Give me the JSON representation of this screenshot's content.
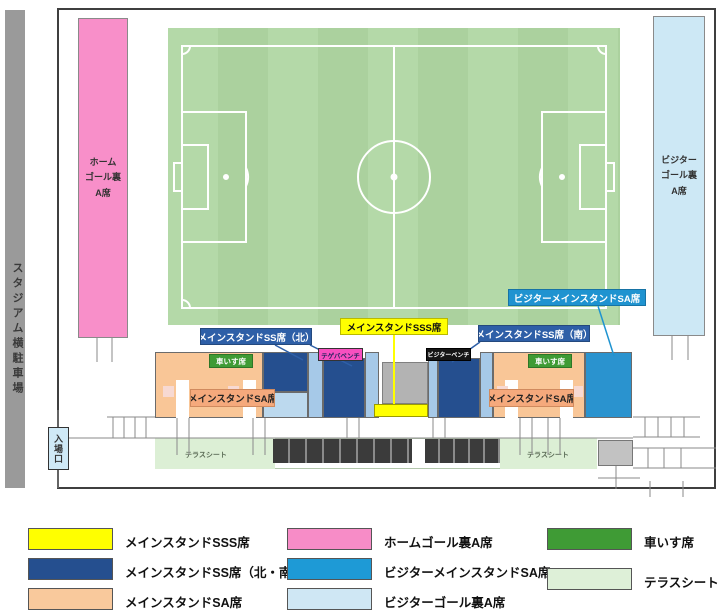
{
  "parking": {
    "label": "スタジアム横駐車場"
  },
  "entrance": {
    "label": "入場口"
  },
  "stands": {
    "home_goal": {
      "lines": [
        "ホーム",
        "ゴール裏",
        "A席"
      ]
    },
    "visitor_goal": {
      "lines": [
        "ビジター",
        "ゴール裏",
        "A席"
      ]
    }
  },
  "labels": {
    "ss_north": "メインスタンドSS席（北）",
    "sss": "メインスタンドSSS席",
    "ss_south": "メインスタンドSS席（南）",
    "visitor_sa": "ビジターメインスタンドSA席",
    "sa_left": "メインスタンドSA席",
    "sa_right": "メインスタンドSA席",
    "wheelchair_left": "車いす席",
    "wheelchair_right": "車いす席",
    "home_bench": "テゲバベンチ",
    "visitor_bench": "ビジターベンチ",
    "terrace_left": "テラスシート",
    "terrace_right": "テラスシート"
  },
  "legend": {
    "items": [
      {
        "label": "メインスタンドSSS席",
        "color": "#ffff00"
      },
      {
        "label": "メインスタンドSS席（北・南）",
        "color": "#254f8f"
      },
      {
        "label": "メインスタンドSA席",
        "color": "#f9c99c"
      },
      {
        "label": "ホームゴール裏A席",
        "color": "#f78cc7"
      },
      {
        "label": "ビジターメインスタンドSA席",
        "color": "#1e9ad6"
      },
      {
        "label": "ビジターゴール裏A席",
        "color": "#cfe7f4"
      },
      {
        "label": "車いす席",
        "color": "#3f9b35"
      },
      {
        "label": "テラスシート",
        "color": "#def0d8"
      }
    ]
  },
  "colors": {
    "pitch": "#afd4a2",
    "stand_ss_blue": "#254f8f",
    "stand_sa_peach": "#f9c697",
    "visitor_sa_blue": "#2a93cf",
    "aisle_light_blue": "#a6c9e8",
    "center_gray": "#b3b3b3",
    "sss_yellow": "#ffff00",
    "wheelchair_green": "#3f9b35",
    "terrace_green": "#dcefd5",
    "home_pink": "#f88fc9",
    "visitor_light_blue": "#cde8f5"
  }
}
